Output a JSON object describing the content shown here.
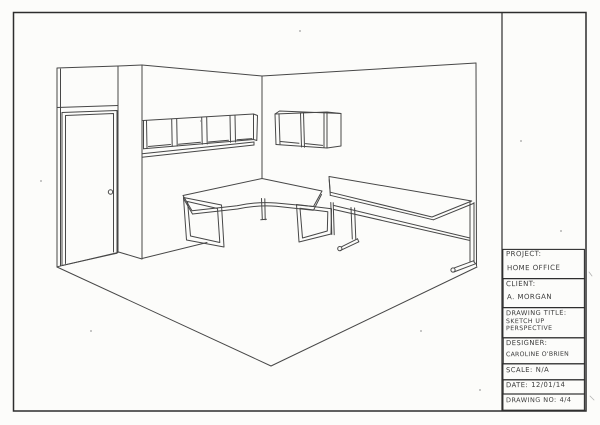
{
  "title_block": {
    "project": {
      "label": "PROJECT:",
      "value": "HOME OFFICE"
    },
    "client": {
      "label": "CLIENT:",
      "value": "A. MORGAN"
    },
    "drawing_title": {
      "label": "DRAWING TITLE:",
      "value_line1": "SKETCH UP",
      "value_line2": "PERSPECTIVE"
    },
    "designer": {
      "label": "DESIGNER:",
      "value": "CAROLINE O'BRIEN"
    },
    "scale": {
      "label": "SCALE:",
      "value": "N/A"
    },
    "date": {
      "label": "DATE:",
      "value": "12/01/14"
    },
    "drawing_no": {
      "label": "DRAWING NO:",
      "value": "4/4"
    }
  },
  "drawing": {
    "scene": "Two-point perspective freehand sketch of a home office room corner",
    "elements": [
      "door with frame and knob",
      "wall column (pillar)",
      "row of four open wall cubbies on left wall",
      "two-cubby wall box on right wall",
      "L-shaped desk with rectangular loop legs",
      "long desk with cantilever feet and under-rails",
      "floor edge lines"
    ],
    "ink_color": "#474747",
    "paper_color": "#fcfcfa"
  }
}
